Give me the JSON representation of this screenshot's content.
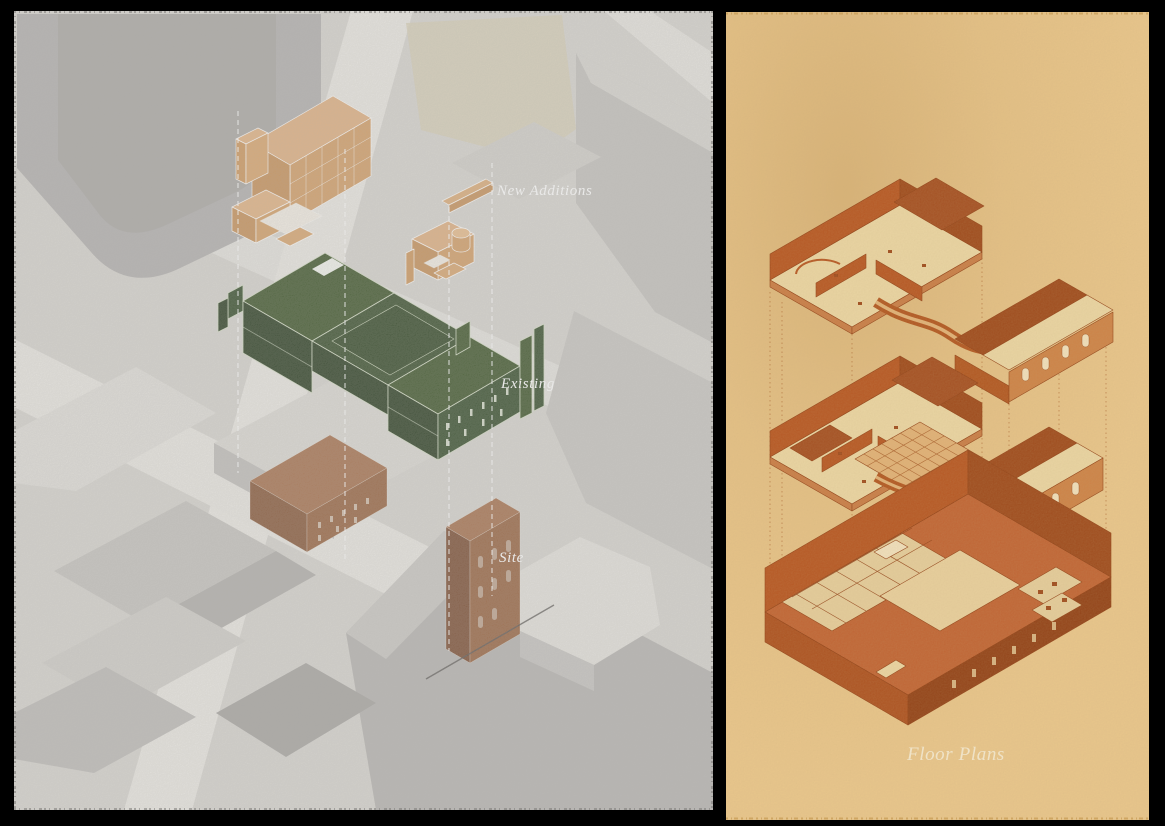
{
  "frame": {
    "background": "#000000"
  },
  "left_panel": {
    "labels": [
      {
        "id": "new-additions",
        "text": "New Additions",
        "color": "#d9a873"
      },
      {
        "id": "existing",
        "text": "Existing",
        "color": "#3e5434"
      },
      {
        "id": "site",
        "text": "Site",
        "color": "#9a6745"
      }
    ],
    "label_text_color": "#ffffff",
    "ground_color": "#d7d5d0",
    "street_color": "#e9e7e2"
  },
  "right_panel": {
    "label": "Floor Plans",
    "label_text_color": "#f8eed6",
    "paper_color": "#ebc88d",
    "ink_color": "#b5521e",
    "floor_color": "#ecd8a6"
  }
}
